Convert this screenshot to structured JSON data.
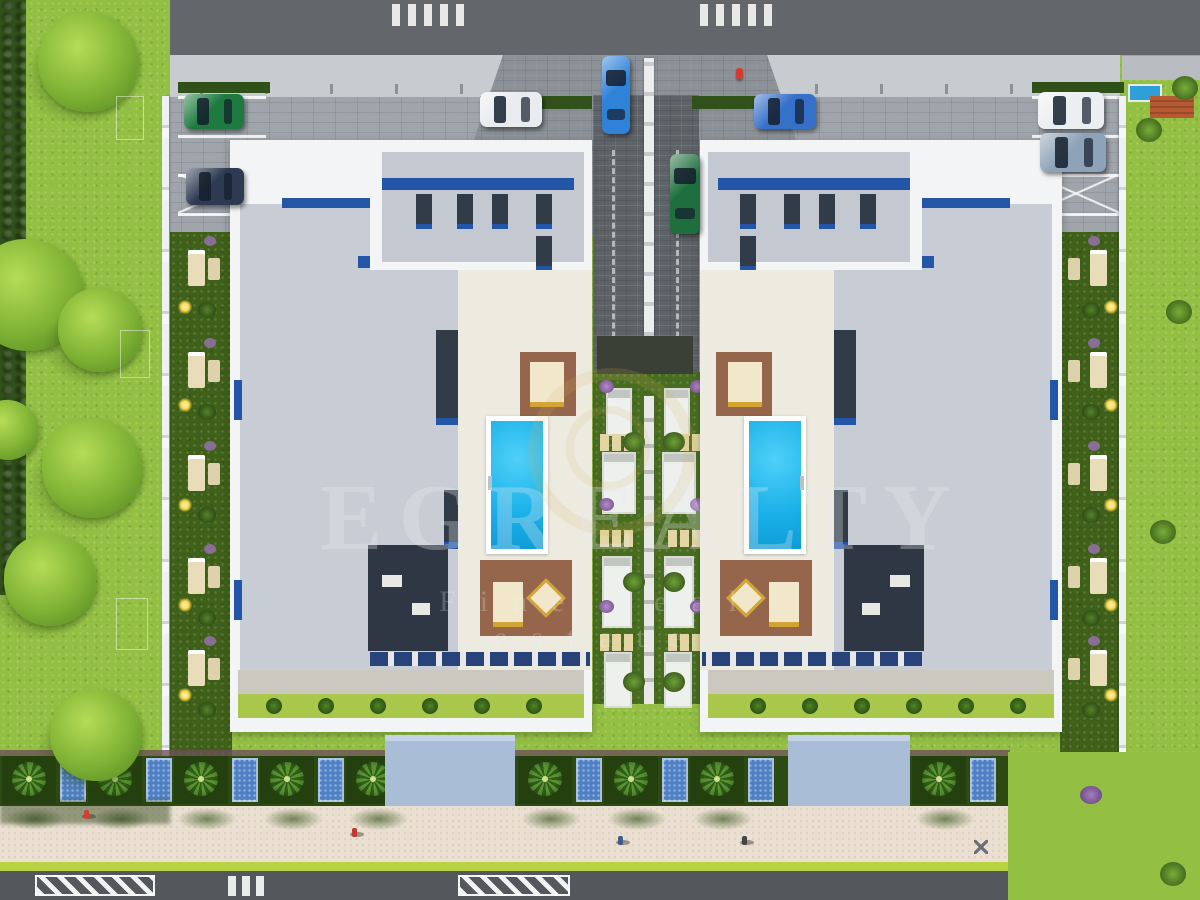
{
  "scene": {
    "kind": "aerial-3d-architectural-render",
    "description": "Top-down site plan render of twin residential blocks with rooftop terraces, two swimming pools, central driveway, parking, gardens and seaside promenade",
    "watermark": {
      "title": "EGREALTY",
      "subtitle": "Fine real estate"
    },
    "palette": {
      "lawn": "#93c043",
      "lawn_shade": "#6f9a2e",
      "hedge_dark": "#31511a",
      "road_dark": "#63676c",
      "road_light": "#c8ccd1",
      "cobble_apron": "#a0a5ac",
      "entrance_cobble": "#8b9197",
      "driveway": "#5e6368",
      "median": "#e8e9ea",
      "parapet_white": "#f3f4f6",
      "roof_tile": "#c8ccd4",
      "roof_fine": "#c4c9d1",
      "skylight_blue": "#2456a8",
      "vent_dark": "#323c48",
      "deck_ivory": "#edeae0",
      "pool_water": "#1db2ea",
      "pool_deep": "#0d9bd6",
      "wood_deck": "#96664c",
      "cabana_cream": "#f1e8cb",
      "gold": "#d2a433",
      "pergola_dark": "#2e3743",
      "garden_green": "#486c20",
      "path_white": "#e6e6e3",
      "stepping_stone": "#e3d6a4",
      "flower_purple": "#9b71b5",
      "plaza_blue": "#a9bdd6",
      "mosaic_blue": "#4f80c4",
      "palm_bed": "#2d4a13",
      "curb_maroon": "#6d4f58",
      "promenade": "#eadfd0",
      "hedge_line": "#b9d243",
      "road_bottom": "#54585d",
      "fence_white": "#eef1f4",
      "light_glow": "#ffd84d",
      "neighbor_roof_orange": "#b65a33"
    }
  },
  "site": {
    "buildings": [
      {
        "id": "block-a",
        "x": 230,
        "y": 140,
        "w": 362,
        "h": 592,
        "mirrored": false
      },
      {
        "id": "block-b",
        "x": 700,
        "y": 140,
        "w": 362,
        "h": 592,
        "mirrored": true
      }
    ],
    "pools_per_building": 1,
    "rooftop_vents_per_building": 7
  },
  "objects": {
    "cars": [
      {
        "name": "green-suv-parked",
        "color": "#1e7a41",
        "x": 184,
        "y": 94,
        "w": 60,
        "h": 35,
        "vertical": false
      },
      {
        "name": "dark-two-tone-car",
        "color": "#2e3a52",
        "x": 186,
        "y": 168,
        "w": 58,
        "h": 37,
        "vertical": false
      },
      {
        "name": "white-hatchback",
        "color": "#e9ecef",
        "x": 480,
        "y": 92,
        "w": 62,
        "h": 35,
        "vertical": false
      },
      {
        "name": "blue-sedan-parked",
        "color": "#3570c9",
        "x": 754,
        "y": 94,
        "w": 62,
        "h": 35,
        "vertical": false
      },
      {
        "name": "white-suv",
        "color": "#eceff1",
        "x": 1038,
        "y": 92,
        "w": 66,
        "h": 37,
        "vertical": false
      },
      {
        "name": "silver-blue-suv",
        "color": "#8fa3b8",
        "x": 1040,
        "y": 133,
        "w": 66,
        "h": 39,
        "vertical": false
      },
      {
        "name": "blue-sedan-driving",
        "color": "#2f82d8",
        "x": 602,
        "y": 56,
        "w": 28,
        "h": 78,
        "vertical": true
      },
      {
        "name": "green-convertible-driving",
        "color": "#1f6f3e",
        "x": 670,
        "y": 154,
        "w": 30,
        "h": 80,
        "vertical": true
      }
    ],
    "trees_left_lawn": [
      {
        "x": 88,
        "y": 62,
        "r": 50
      },
      {
        "x": 28,
        "y": 295,
        "r": 56
      },
      {
        "x": 100,
        "y": 330,
        "r": 42
      },
      {
        "x": 92,
        "y": 468,
        "r": 50
      },
      {
        "x": 50,
        "y": 580,
        "r": 46
      },
      {
        "x": 96,
        "y": 735,
        "r": 46
      },
      {
        "x": 8,
        "y": 430,
        "r": 30
      }
    ],
    "lawn_marking_rects": [
      {
        "x": 116,
        "y": 96,
        "w": 26,
        "h": 42
      },
      {
        "x": 120,
        "y": 330,
        "w": 28,
        "h": 46
      },
      {
        "x": 116,
        "y": 598,
        "w": 30,
        "h": 50
      }
    ],
    "people": [
      {
        "x": 352,
        "y": 828,
        "shirt": "#c0392b"
      },
      {
        "x": 618,
        "y": 836,
        "shirt": "#3b5f8a"
      },
      {
        "x": 742,
        "y": 836,
        "shirt": "#444444"
      },
      {
        "x": 84,
        "y": 810,
        "shirt": "#d04030"
      }
    ],
    "drone": {
      "x": 974,
      "y": 840
    },
    "hydrant": {
      "x": 736,
      "y": 68,
      "color": "#d63a2f"
    },
    "garden_lights_y": [
      300,
      398,
      498,
      598,
      688
    ],
    "sunbed_rows_y": [
      250,
      352,
      455,
      558,
      650
    ],
    "plazas": [
      {
        "x": 385,
        "w": 130
      },
      {
        "x": 788,
        "w": 122
      }
    ],
    "palm_bed_xs": [
      2,
      88,
      174,
      260,
      346,
      518,
      604,
      690,
      912
    ],
    "mosaic_skip_xs": [
      346
    ],
    "crosswalk_groups_top_x": [
      392,
      700
    ],
    "road_tick_xs": [
      200,
      265,
      330,
      395,
      460,
      815,
      880,
      945,
      1010,
      1075
    ],
    "bottom_hatch": [
      {
        "x": 35,
        "w": 120
      },
      {
        "x": 458,
        "w": 112
      }
    ],
    "bottom_crosswalk_x": 228
  },
  "central_garden": {
    "platforms": [
      {
        "x": 606,
        "y": 388,
        "w": 26,
        "h": 48
      },
      {
        "x": 664,
        "y": 388,
        "w": 26,
        "h": 48
      },
      {
        "x": 602,
        "y": 452,
        "w": 34,
        "h": 62
      },
      {
        "x": 662,
        "y": 452,
        "w": 34,
        "h": 62
      },
      {
        "x": 602,
        "y": 556,
        "w": 30,
        "h": 72
      },
      {
        "x": 664,
        "y": 556,
        "w": 30,
        "h": 72
      },
      {
        "x": 604,
        "y": 652,
        "w": 28,
        "h": 56
      },
      {
        "x": 664,
        "y": 652,
        "w": 28,
        "h": 56
      }
    ],
    "stone_rows_y": [
      434,
      530,
      634
    ],
    "flowers": [
      {
        "x": 599,
        "y": 380
      },
      {
        "x": 690,
        "y": 380
      },
      {
        "x": 599,
        "y": 498
      },
      {
        "x": 690,
        "y": 498
      },
      {
        "x": 599,
        "y": 600
      },
      {
        "x": 690,
        "y": 600
      }
    ]
  },
  "neighbor_top_right": {
    "pool": {
      "x": 1128,
      "y": 84,
      "w": 30,
      "h": 14
    },
    "roof": {
      "x": 1150,
      "y": 96,
      "w": 44,
      "h": 22
    }
  }
}
